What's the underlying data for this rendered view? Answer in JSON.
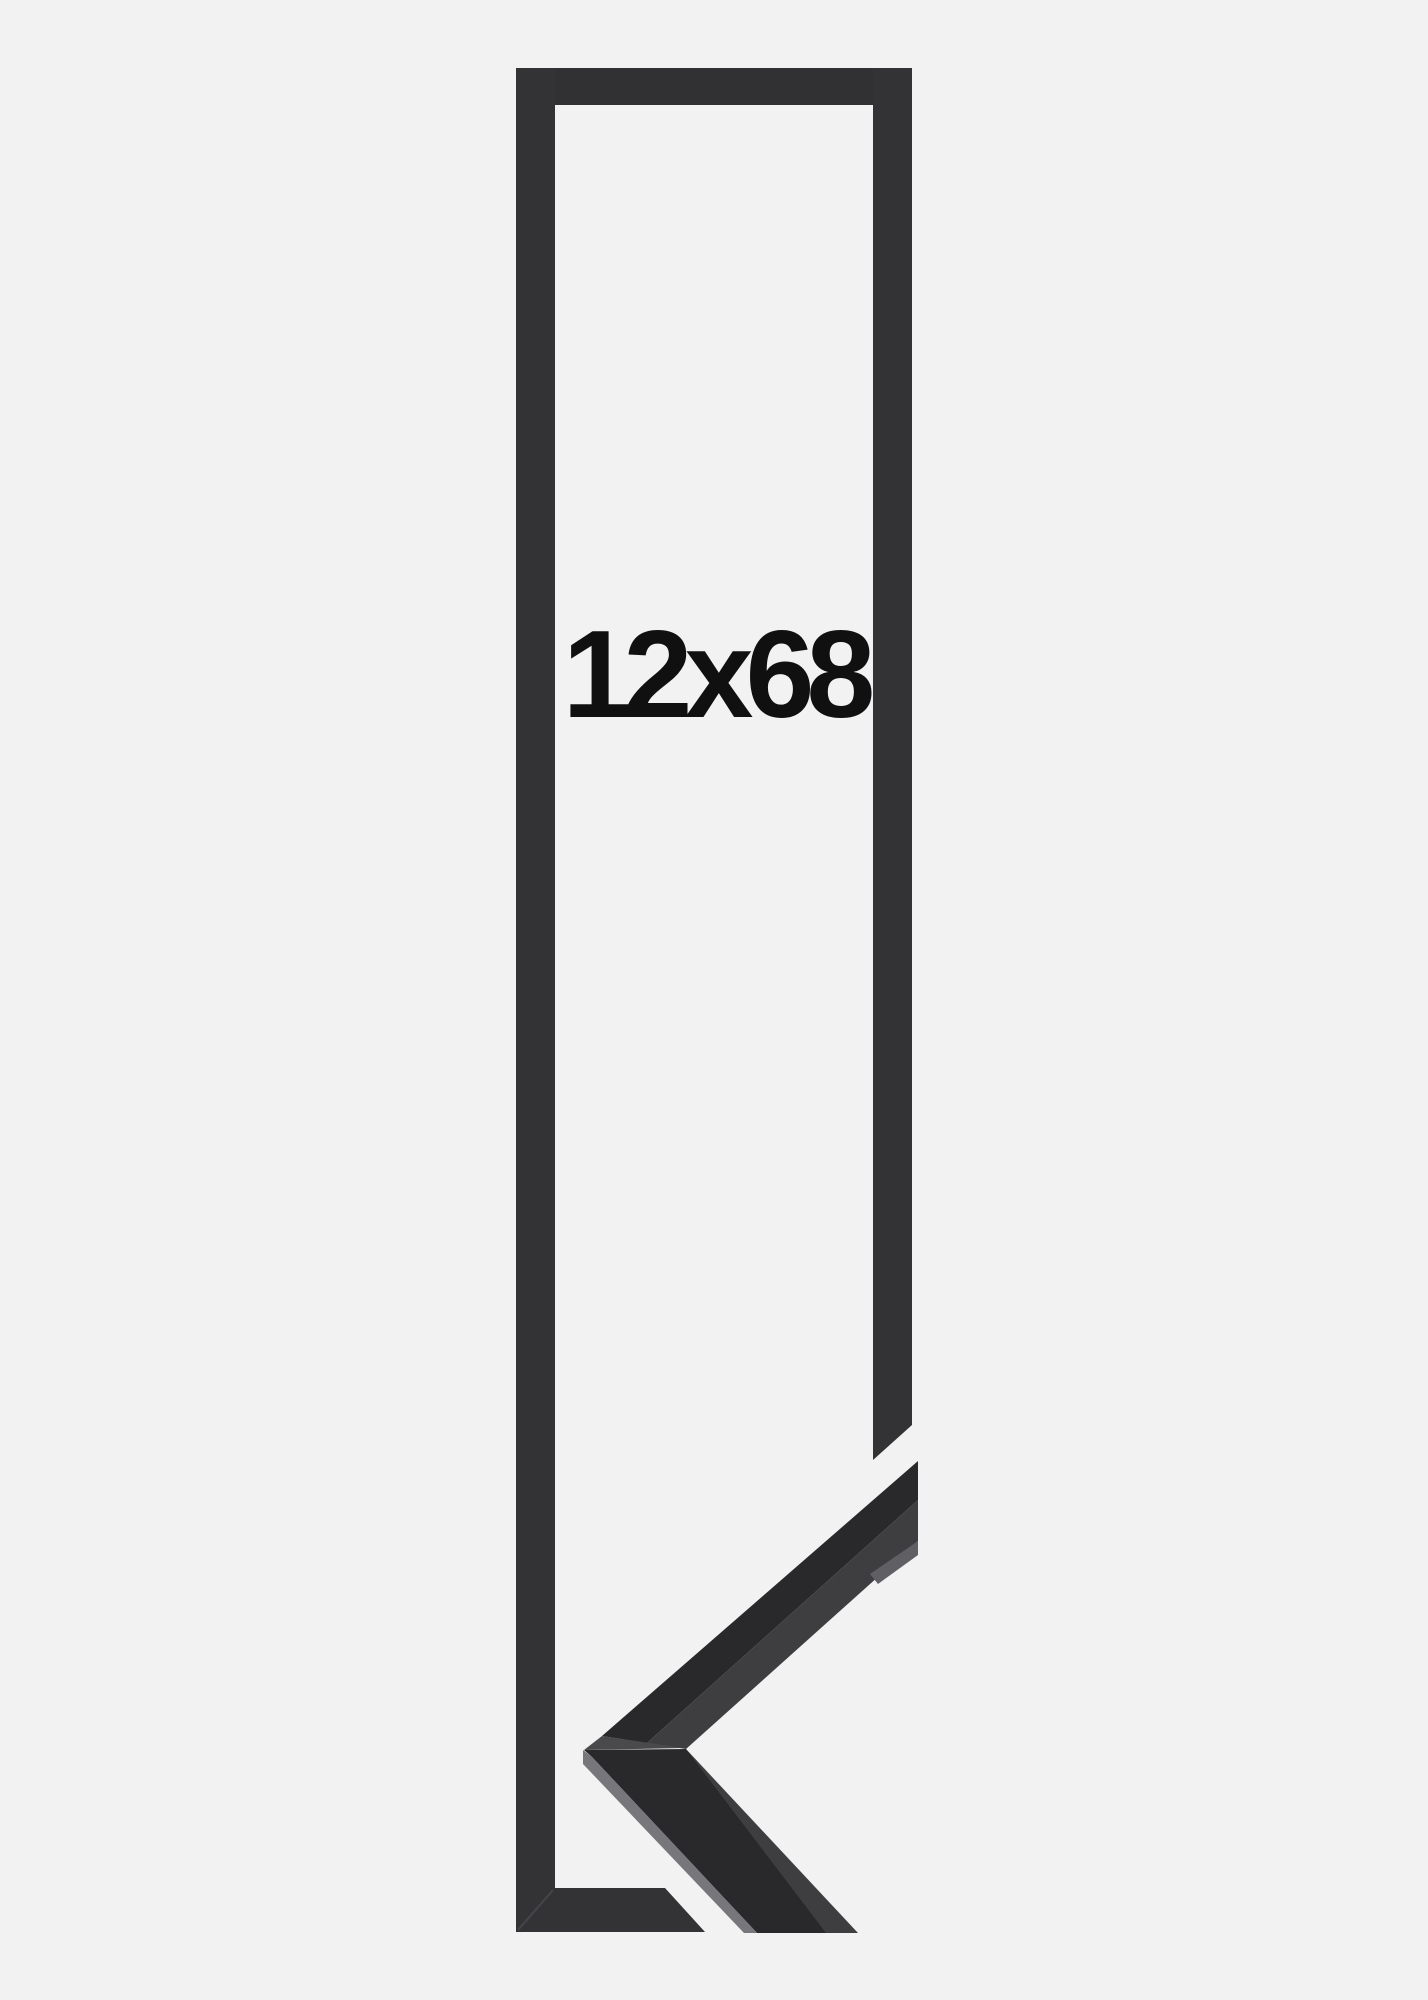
{
  "label": {
    "size_text": "12x68"
  },
  "colors": {
    "background": "#f2f2f2",
    "frame_bar": "#333336",
    "frame_bar_top": "#313134",
    "miter_seam": "#55555a",
    "label_text": "#101010",
    "moulding_face_dark": "#29292b",
    "moulding_face_texture": "#3e3e41",
    "moulding_apex_top": "#4a4a4d",
    "moulding_edge_highlight": "#77777b",
    "moulding_end_highlight": "#606064"
  }
}
